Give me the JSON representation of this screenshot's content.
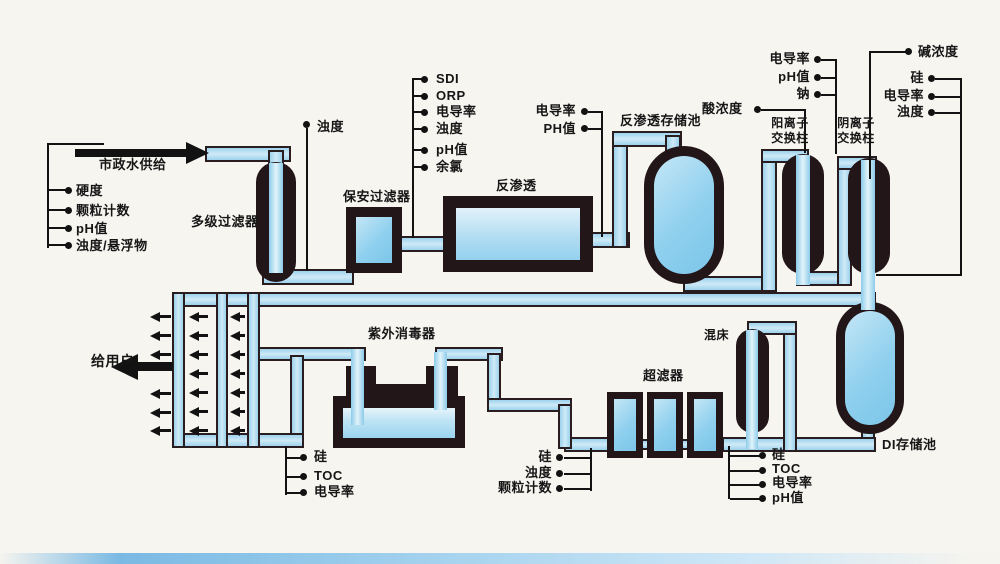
{
  "diagram_title": "",
  "feed": {
    "label": "市政水供给"
  },
  "to_user": {
    "label": "给用户"
  },
  "equipment": {
    "multistage_filter": "多级过滤器",
    "security_filter": "保安过滤器",
    "ro": "反渗透",
    "ro_tank": "反渗透存储池",
    "cation_line1": "阳离子",
    "cation_line2": "交换柱",
    "anion_line1": "阴离子",
    "anion_line2": "交换柱",
    "uv": "紫外消毒器",
    "uf": "超滤器",
    "mixed_bed": "混床",
    "di_tank": "DI存储池"
  },
  "annotations": {
    "feed_params": {
      "items": [
        "硬度",
        "颗粒计数",
        "pH值",
        "浊度/悬浮物"
      ]
    },
    "turbidity_top": {
      "label": "浊度"
    },
    "pre_ro": {
      "items": [
        "SDI",
        "ORP",
        "电导率",
        "浊度",
        "pH值",
        "余氯"
      ]
    },
    "ro_out": {
      "items": [
        "电导率",
        "PH值"
      ]
    },
    "acid": {
      "label": "酸浓度"
    },
    "cation_out": {
      "items": [
        "电导率",
        "pH值",
        "钠"
      ]
    },
    "alkali": {
      "label": "碱浓度"
    },
    "anion_out": {
      "items": [
        "硅",
        "电导率",
        "浊度"
      ]
    },
    "uv_in": {
      "items": [
        "硅",
        "TOC",
        "电导率"
      ]
    },
    "uf_in": {
      "items": [
        "硅",
        "浊度",
        "颗粒计数"
      ]
    },
    "polish_out": {
      "items": [
        "硅",
        "TOC",
        "电导率",
        "pH值"
      ]
    }
  },
  "colors": {
    "pipe_blue": "#a9d9f0",
    "vessel_dark": "#231619",
    "tank_fill": "#8fd0ee",
    "background": "#f7f5f0",
    "line_black": "#121212"
  }
}
